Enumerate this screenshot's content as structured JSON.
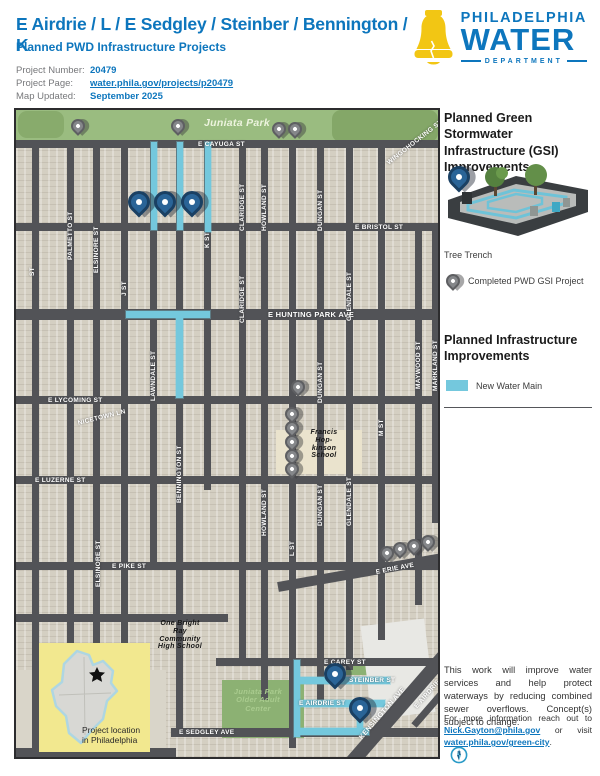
{
  "header": {
    "title": "E Airdrie / L / E Sedgley / Steinber / Bennington / K",
    "subtitle": "Planned PWD Infrastructure Projects",
    "info": [
      {
        "label": "Project Number:",
        "value": "20479"
      },
      {
        "label": "Project Page:",
        "value": "water.phila.gov/projects/p20479"
      },
      {
        "label": "Map Updated:",
        "value": "September 2025"
      }
    ],
    "logo": {
      "line1": "PHILADELPHIA",
      "line2": "WATER",
      "line3": "DEPARTMENT"
    }
  },
  "colors": {
    "brand_blue": "#0d76bd",
    "bell_yellow": "#f2c614",
    "water_main": "#74c8dd",
    "planned_pin": "#2a6497",
    "completed_pin": "#85878a",
    "park_green": "#9abc80",
    "inset_yellow": "#f2e88f"
  },
  "sidebar": {
    "gsi_heading": "Planned Green Stormwater Infrastructure (GSI) Improvements",
    "tree_trench_label": "Tree Trench",
    "completed_label": "Completed PWD GSI Project",
    "infra_heading": "Planned Infrastructure Improvements",
    "water_main_label": "New Water Main",
    "para1": "This work will improve water services and help protect waterways by reducing combined sewer overflows. Concept(s) subject to change.",
    "para2_parts": [
      {
        "text": "For more information reach out to ",
        "link": false
      },
      {
        "text": "Nick.Gayton@phila.gov",
        "link": true
      },
      {
        "text": " or visit ",
        "link": false
      },
      {
        "text": "water.phila.gov/green-city",
        "link": true
      },
      {
        "text": ".",
        "link": false
      }
    ]
  },
  "map": {
    "inset_caption": "Project location in Philadelphia",
    "streets": [
      {
        "x": 0,
        "y": 30,
        "w": 422,
        "h": 8
      },
      {
        "x": 0,
        "y": 113,
        "w": 422,
        "h": 8
      },
      {
        "x": 0,
        "y": 199,
        "w": 422,
        "h": 11
      },
      {
        "x": 0,
        "y": 286,
        "w": 422,
        "h": 8
      },
      {
        "x": 0,
        "y": 366,
        "w": 422,
        "h": 8
      },
      {
        "x": 0,
        "y": 452,
        "w": 422,
        "h": 8
      },
      {
        "x": 0,
        "y": 504,
        "w": 212,
        "h": 8
      },
      {
        "x": 200,
        "y": 548,
        "w": 222,
        "h": 8
      },
      {
        "x": 155,
        "y": 618,
        "w": 267,
        "h": 9
      },
      {
        "x": 0,
        "y": 638,
        "w": 160,
        "h": 9
      },
      {
        "x": 262,
        "y": 472,
        "w": 180,
        "h": 10,
        "rot": -10
      },
      {
        "x": 322,
        "y": 661,
        "w": 175,
        "h": 14,
        "rot": -49
      },
      {
        "x": 398,
        "y": 612,
        "w": 80,
        "h": 7,
        "rot": -49
      },
      {
        "x": 16,
        "y": 30,
        "w": 7,
        "h": 608
      },
      {
        "x": 51,
        "y": 30,
        "w": 7,
        "h": 608
      },
      {
        "x": 77,
        "y": 30,
        "w": 7,
        "h": 608
      },
      {
        "x": 105,
        "y": 30,
        "w": 7,
        "h": 608
      },
      {
        "x": 134,
        "y": 30,
        "w": 7,
        "h": 430
      },
      {
        "x": 160,
        "y": 30,
        "w": 7,
        "h": 597
      },
      {
        "x": 188,
        "y": 30,
        "w": 7,
        "h": 350
      },
      {
        "x": 223,
        "y": 30,
        "w": 7,
        "h": 526
      },
      {
        "x": 245,
        "y": 30,
        "w": 7,
        "h": 560
      },
      {
        "x": 273,
        "y": 30,
        "w": 7,
        "h": 608
      },
      {
        "x": 301,
        "y": 30,
        "w": 7,
        "h": 560
      },
      {
        "x": 330,
        "y": 30,
        "w": 7,
        "h": 530
      },
      {
        "x": 362,
        "y": 30,
        "w": 7,
        "h": 500
      },
      {
        "x": 399,
        "y": 113,
        "w": 7,
        "h": 382
      },
      {
        "x": 416,
        "y": 113,
        "w": 6,
        "h": 300
      }
    ],
    "areas": [
      {
        "x": 0,
        "y": 0,
        "w": 422,
        "h": 30,
        "c": "#9abc80"
      },
      {
        "x": 2,
        "y": 1,
        "w": 46,
        "h": 27,
        "c": "#88ab6c",
        "r": 9
      },
      {
        "x": 316,
        "y": 0,
        "w": 106,
        "h": 32,
        "c": "#84a768",
        "r": 9
      },
      {
        "x": 206,
        "y": 570,
        "w": 82,
        "h": 58,
        "c": "#8cb173"
      },
      {
        "x": 330,
        "y": 552,
        "w": 24,
        "h": 13,
        "c": "#8cb173"
      },
      {
        "x": 260,
        "y": 320,
        "w": 86,
        "h": 44,
        "c": "#eae3cd"
      },
      {
        "x": 350,
        "y": 512,
        "w": 64,
        "h": 94,
        "c": "#e8e8e4",
        "rot": -7
      },
      {
        "x": 0,
        "y": 560,
        "w": 150,
        "h": 78,
        "c": "#d9d5c9"
      }
    ],
    "water_mains": [
      {
        "x": 135,
        "y": 32,
        "w": 6,
        "h": 88
      },
      {
        "x": 161,
        "y": 32,
        "w": 6,
        "h": 88
      },
      {
        "x": 189,
        "y": 32,
        "w": 6,
        "h": 90
      },
      {
        "x": 110,
        "y": 201,
        "w": 84,
        "h": 7
      },
      {
        "x": 160,
        "y": 208,
        "w": 7,
        "h": 80
      },
      {
        "x": 278,
        "y": 550,
        "w": 6,
        "h": 77
      },
      {
        "x": 281,
        "y": 567,
        "w": 93,
        "h": 7
      },
      {
        "x": 281,
        "y": 590,
        "w": 88,
        "h": 7
      },
      {
        "x": 281,
        "y": 618,
        "w": 72,
        "h": 7
      },
      {
        "x": 341,
        "y": 595,
        "w": 6,
        "h": 28
      }
    ],
    "pins": [
      {
        "k": "blue",
        "x": 123,
        "y": 103
      },
      {
        "k": "blue",
        "x": 149,
        "y": 103
      },
      {
        "k": "blue",
        "x": 176,
        "y": 103
      },
      {
        "k": "blue",
        "x": 319,
        "y": 575
      },
      {
        "k": "blue",
        "x": 344,
        "y": 609
      },
      {
        "k": "gray",
        "x": 62,
        "y": 23
      },
      {
        "k": "gray",
        "x": 162,
        "y": 23
      },
      {
        "k": "gray",
        "x": 263,
        "y": 26
      },
      {
        "k": "gray",
        "x": 279,
        "y": 26
      },
      {
        "k": "gray",
        "x": 282,
        "y": 284
      },
      {
        "k": "gray",
        "x": 276,
        "y": 311
      },
      {
        "k": "gray",
        "x": 276,
        "y": 325
      },
      {
        "k": "gray",
        "x": 276,
        "y": 339
      },
      {
        "k": "gray",
        "x": 276,
        "y": 353
      },
      {
        "k": "gray",
        "x": 276,
        "y": 366
      },
      {
        "k": "gray",
        "x": 371,
        "y": 450
      },
      {
        "k": "gray",
        "x": 384,
        "y": 446
      },
      {
        "k": "gray",
        "x": 398,
        "y": 443
      },
      {
        "k": "gray",
        "x": 412,
        "y": 439
      }
    ],
    "labels": [
      {
        "t": "E CAYUGA ST",
        "x": 182,
        "y": 31,
        "cls": "sh"
      },
      {
        "t": "E BRISTOL ST",
        "x": 339,
        "y": 114,
        "cls": "sh"
      },
      {
        "t": "E HUNTING PARK AVE",
        "x": 252,
        "y": 201,
        "cls": "sh",
        "size": 7.5
      },
      {
        "t": "E LYCOMING ST",
        "x": 32,
        "y": 287,
        "cls": "sh"
      },
      {
        "t": "NICETOWN LN",
        "x": 62,
        "y": 310,
        "cls": "sh",
        "rot": -14
      },
      {
        "t": "E LUZERNE ST",
        "x": 19,
        "y": 367,
        "cls": "sh"
      },
      {
        "t": "E PIKE ST",
        "x": 96,
        "y": 453,
        "cls": "sh"
      },
      {
        "t": "E ERIE AVE",
        "x": 360,
        "y": 459,
        "cls": "sh",
        "rot": -11
      },
      {
        "t": "E CAREY ST",
        "x": 308,
        "y": 549,
        "cls": "sh"
      },
      {
        "t": "STEINBER ST",
        "x": 333,
        "y": 567,
        "cls": "sh"
      },
      {
        "t": "E AIRDRIE ST",
        "x": 283,
        "y": 590,
        "cls": "sh"
      },
      {
        "t": "E SEDGLEY AVE",
        "x": 163,
        "y": 619,
        "cls": "sh"
      },
      {
        "t": "KENSINGTON AVE",
        "x": 345,
        "y": 625,
        "cls": "sh",
        "rot": -49,
        "size": 7
      },
      {
        "t": "E AIRDRIE",
        "x": 400,
        "y": 594,
        "cls": "sh",
        "rot": -49
      },
      {
        "t": "WINGOHOCKING ST",
        "x": 372,
        "y": 50,
        "cls": "sh",
        "rot": -38
      },
      {
        "t": "PALMETTO ST",
        "x": 51,
        "y": 150,
        "cls": "sv"
      },
      {
        "t": "ELSINORE ST",
        "x": 77,
        "y": 163,
        "cls": "sv"
      },
      {
        "t": "ELSINORE ST",
        "x": 79,
        "y": 477,
        "cls": "sv"
      },
      {
        "t": "J ST",
        "x": 105,
        "y": 186,
        "cls": "sv"
      },
      {
        "t": "LAWNDALE ST",
        "x": 134,
        "y": 291,
        "cls": "sv"
      },
      {
        "t": "BENNINGTON ST",
        "x": 160,
        "y": 393,
        "cls": "sv"
      },
      {
        "t": "K ST",
        "x": 188,
        "y": 138,
        "cls": "sv"
      },
      {
        "t": "CLARIDGE ST",
        "x": 223,
        "y": 121,
        "cls": "sv"
      },
      {
        "t": "CLARIDGE ST",
        "x": 223,
        "y": 213,
        "cls": "sv"
      },
      {
        "t": "HOWLAND ST",
        "x": 245,
        "y": 121,
        "cls": "sv"
      },
      {
        "t": "HOWLAND ST",
        "x": 245,
        "y": 426,
        "cls": "sv"
      },
      {
        "t": "DUNGAN ST",
        "x": 301,
        "y": 121,
        "cls": "sv"
      },
      {
        "t": "DUNGAN ST",
        "x": 301,
        "y": 293,
        "cls": "sv"
      },
      {
        "t": "DUNGAN ST",
        "x": 301,
        "y": 416,
        "cls": "sv"
      },
      {
        "t": "GLENDALE ST",
        "x": 330,
        "y": 211,
        "cls": "sv"
      },
      {
        "t": "GLENDALE ST",
        "x": 330,
        "y": 416,
        "cls": "sv"
      },
      {
        "t": "M ST",
        "x": 362,
        "y": 326,
        "cls": "sv"
      },
      {
        "t": "MAYWOOD ST",
        "x": 399,
        "y": 279,
        "cls": "sv"
      },
      {
        "t": "MARKLAND ST",
        "x": 416,
        "y": 281,
        "cls": "sv"
      },
      {
        "t": "L ST",
        "x": 273,
        "y": 446,
        "cls": "sv"
      },
      {
        "t": "ST",
        "x": 13,
        "y": 166,
        "cls": "sv"
      },
      {
        "t": "Juniata Park",
        "x": 188,
        "y": 8,
        "cls": "park1"
      },
      {
        "t": "Juniata Park\nOlder Adult\nCenter",
        "x": 204,
        "y": 578,
        "w": 76,
        "cls": "park2"
      },
      {
        "t": "Francis\nHop-\nkinson\nSchool",
        "x": 284,
        "y": 319,
        "w": 48,
        "cls": "poi"
      },
      {
        "t": "One Bright\nRay\nCommunity\nHigh School",
        "x": 134,
        "y": 510,
        "w": 60,
        "cls": "poi"
      }
    ]
  }
}
